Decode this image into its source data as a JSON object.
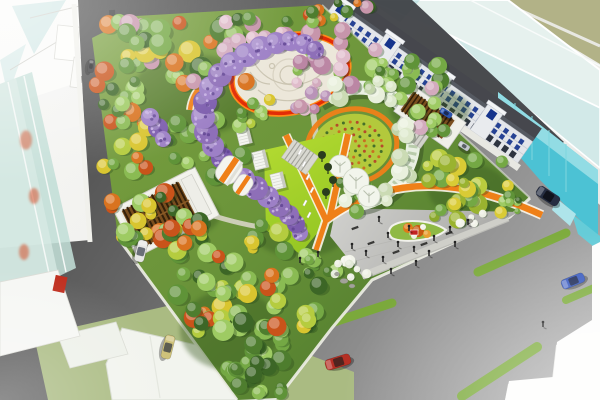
{
  "scene": {
    "description": "Aerial perspective rendering of an urban pocket-park masterplan: dense mixed tree canopy, purple wisteria tunnel, white circular plaza with red-orange ring path, spiral green trellis around a circular flower garden, chartreuse event lawn with orange V paths, timber pergola pavilions, grey entry plaza with pedestrians, surrounded by roads with cars, shophouse row and translucent glass towers",
    "canvas": {
      "width": 600,
      "height": 400
    }
  },
  "palette": {
    "asphalt_dark": "#3f3f3f",
    "asphalt_mid": "#656565",
    "asphalt_light": "#b5b5b5",
    "park_green": "#7aa040",
    "park_green_dark": "#4e7a2c",
    "lawn_bright": "#a8d32f",
    "path_orange": "#ef8018",
    "ring_red": "#e22c06",
    "plaza_white": "#ece7da",
    "concrete": "#c6c6c3",
    "curb_white": "#f0efe8",
    "glass_teal": "#c2ded6",
    "glass_cyan": "#4cc2d4",
    "building_white": "#f7f7f5",
    "shophouse_window": "#16348c",
    "pergola_brown": "#7a4e1e",
    "pergola_slat": "#33200a",
    "wisteria_purple": "#8e6fb8",
    "cherry_pink": "#c795ab",
    "lane_stripe_green": "#79af2e",
    "people_dark": "#2a2a2a"
  },
  "tree_palettes": {
    "greens": [
      "#3c6626",
      "#4e7d2e",
      "#5f9338",
      "#74a844",
      "#8abb53",
      "#9ecb63"
    ],
    "greensAccent": [
      "#3c6626",
      "#4e7d2e",
      "#5f9338",
      "#74a844",
      "#8abb53",
      "#9ecb63",
      "#d9731f",
      "#c9531a",
      "#d9c52f",
      "#b5cc3f"
    ],
    "mixNW": [
      "#3c6626",
      "#4e7d2e",
      "#5f9338",
      "#74a844",
      "#8abb53",
      "#d9731f",
      "#d9c52f",
      "#c795ab",
      "#c9531a",
      "#9ecb63"
    ],
    "pinks": [
      "#c795ab",
      "#d3abbe",
      "#bb86a4",
      "#e0bccb",
      "#b993b8"
    ],
    "pinkGreen": [
      "#c795ab",
      "#d3abbe",
      "#bb86a4",
      "#e0bccb",
      "#8abb53",
      "#9ecb63"
    ],
    "greenPink": [
      "#4e7d2e",
      "#5f9338",
      "#74a844",
      "#8abb53",
      "#9ecb63",
      "#c795ab",
      "#d3abbe"
    ],
    "yellowGreens": [
      "#b9cc3e",
      "#cbd84a",
      "#9ab32f",
      "#d9cb35",
      "#8aa82c",
      "#74a844"
    ],
    "sage": [
      "#dde8cc",
      "#cbdbb4",
      "#e9f0dd",
      "#c2d4aa"
    ],
    "whites": [
      "#edefe3",
      "#e2e8d6",
      "#f2f4ea"
    ]
  },
  "tree_clusters": [
    {
      "cx": 175,
      "cy": 55,
      "rx": 72,
      "ry": 34,
      "n": 40,
      "rmin": 6,
      "rmax": 12,
      "pal": "mixNW"
    },
    {
      "cx": 122,
      "cy": 128,
      "rx": 26,
      "ry": 52,
      "n": 22,
      "rmin": 5,
      "rmax": 10,
      "pal": "greensAccent"
    },
    {
      "cx": 158,
      "cy": 214,
      "rx": 52,
      "ry": 26,
      "n": 22,
      "rmin": 5,
      "rmax": 10,
      "pal": "greensAccent"
    },
    {
      "cx": 205,
      "cy": 150,
      "rx": 38,
      "ry": 32,
      "n": 16,
      "rmin": 5,
      "rmax": 10,
      "pal": "greens"
    },
    {
      "cx": 252,
      "cy": 34,
      "rx": 40,
      "ry": 17,
      "n": 12,
      "rmin": 5,
      "rmax": 9,
      "pal": "pinks"
    },
    {
      "cx": 342,
      "cy": 58,
      "rx": 46,
      "ry": 30,
      "n": 18,
      "rmin": 5,
      "rmax": 10,
      "pal": "pinkGreen"
    },
    {
      "cx": 305,
      "cy": 97,
      "rx": 26,
      "ry": 16,
      "n": 8,
      "rmin": 4,
      "rmax": 8,
      "pal": "pinks"
    },
    {
      "cx": 300,
      "cy": 14,
      "rx": 70,
      "ry": 11,
      "n": 14,
      "rmin": 4,
      "rmax": 8,
      "pal": "mixNW"
    },
    {
      "cx": 392,
      "cy": 80,
      "rx": 50,
      "ry": 26,
      "n": 18,
      "rmin": 5,
      "rmax": 9,
      "pal": "greenPink"
    },
    {
      "cx": 468,
      "cy": 188,
      "rx": 44,
      "ry": 32,
      "n": 24,
      "rmin": 5,
      "rmax": 10,
      "pal": "yellowGreens"
    },
    {
      "cx": 232,
      "cy": 238,
      "rx": 55,
      "ry": 18,
      "n": 18,
      "rmin": 5,
      "rmax": 10,
      "pal": "greensAccent"
    },
    {
      "cx": 210,
      "cy": 295,
      "rx": 40,
      "ry": 40,
      "n": 24,
      "rmin": 6,
      "rmax": 11,
      "pal": "greensAccent"
    },
    {
      "cx": 255,
      "cy": 345,
      "rx": 35,
      "ry": 35,
      "n": 20,
      "rmin": 6,
      "rmax": 11,
      "pal": "greens"
    },
    {
      "cx": 290,
      "cy": 300,
      "rx": 30,
      "ry": 28,
      "n": 14,
      "rmin": 5,
      "rmax": 10,
      "pal": "greensAccent"
    },
    {
      "cx": 320,
      "cy": 265,
      "rx": 20,
      "ry": 15,
      "n": 8,
      "rmin": 4,
      "rmax": 8,
      "pal": "greens"
    },
    {
      "cx": 258,
      "cy": 382,
      "rx": 26,
      "ry": 14,
      "n": 8,
      "rmin": 5,
      "rmax": 9,
      "pal": "greens"
    },
    {
      "cx": 360,
      "cy": 198,
      "rx": 26,
      "ry": 16,
      "n": 9,
      "rmin": 4,
      "rmax": 8,
      "pal": "greens"
    },
    {
      "cx": 255,
      "cy": 118,
      "rx": 26,
      "ry": 20,
      "n": 8,
      "rmin": 4,
      "rmax": 8,
      "pal": "greensAccent"
    },
    {
      "cx": 432,
      "cy": 122,
      "rx": 22,
      "ry": 14,
      "n": 7,
      "rmin": 4,
      "rmax": 8,
      "pal": "greenPink"
    },
    {
      "cx": 506,
      "cy": 206,
      "rx": 15,
      "ry": 11,
      "n": 6,
      "rmin": 3,
      "rmax": 6,
      "pal": "greens"
    },
    {
      "cx": 372,
      "cy": 92,
      "rx": 40,
      "ry": 13,
      "n": 10,
      "rmin": 5,
      "rmax": 9,
      "pal": "sage"
    },
    {
      "cx": 408,
      "cy": 148,
      "rx": 13,
      "ry": 28,
      "n": 8,
      "rmin": 5,
      "rmax": 9,
      "pal": "sage"
    },
    {
      "cx": 366,
      "cy": 196,
      "rx": 22,
      "ry": 9,
      "n": 6,
      "rmin": 4,
      "rmax": 8,
      "pal": "sage"
    },
    {
      "cx": 348,
      "cy": 268,
      "rx": 20,
      "ry": 10,
      "n": 8,
      "rmin": 3,
      "rmax": 6,
      "pal": "whites"
    },
    {
      "cx": 470,
      "cy": 218,
      "rx": 13,
      "ry": 6,
      "n": 5,
      "rmin": 3,
      "rmax": 5,
      "pal": "whites"
    }
  ],
  "wisteria_tunnel": {
    "colors": [
      "#8e6fb8",
      "#9d80c6",
      "#7c5cad"
    ],
    "dot_light": "#c9b4e4",
    "dot_dark": "#5e4290",
    "blobs": [
      [
        300,
        233,
        8
      ],
      [
        296,
        224,
        9
      ],
      [
        289,
        215,
        10
      ],
      [
        279,
        206,
        11
      ],
      [
        268,
        197,
        11
      ],
      [
        256,
        188,
        12
      ],
      [
        244,
        179,
        11
      ],
      [
        222,
        158,
        11
      ],
      [
        213,
        146,
        11
      ],
      [
        206,
        132,
        12
      ],
      [
        203,
        117,
        12
      ],
      [
        205,
        102,
        12
      ],
      [
        211,
        88,
        12
      ],
      [
        220,
        75,
        12
      ],
      [
        232,
        64,
        12
      ],
      [
        246,
        55,
        12
      ],
      [
        261,
        48,
        12
      ],
      [
        276,
        43,
        11
      ],
      [
        290,
        41,
        10
      ],
      [
        304,
        44,
        10
      ],
      [
        315,
        50,
        9
      ],
      [
        158,
        128,
        10
      ],
      [
        150,
        117,
        9
      ],
      [
        163,
        139,
        8
      ]
    ]
  },
  "flower_garden": {
    "cx": 352,
    "cy": 146,
    "rx": 40,
    "ry": 32,
    "rot": -10,
    "bed_color": "#b3c93c",
    "ring_color": "#ef8018",
    "row_radii": [
      30,
      22,
      14,
      7
    ],
    "dot_colors": [
      "#b5452a",
      "#3f6b28",
      "#c96a20"
    ]
  },
  "shophouse": {
    "length": 240,
    "height": 26,
    "floors_y": [
      4,
      11
    ],
    "ground_y": 18.5,
    "cols": 25,
    "spacing": 9.35,
    "win_w": 4.6,
    "win_h": 5,
    "window_color": "#16348c",
    "ground_color": "#2e3440",
    "towers_x": [
      -2,
      58,
      120,
      182
    ]
  },
  "cars": [
    {
      "name": "car-white-west-road",
      "x": 141,
      "y": 251,
      "rot": 104,
      "len": 22,
      "wid": 10,
      "body": "#e6e6e4",
      "glass": "#6a6f78"
    },
    {
      "name": "car-khaki-west-road",
      "x": 168,
      "y": 347,
      "rot": 104,
      "len": 24,
      "wid": 10,
      "body": "#cfc27a",
      "glass": "#5c5c50"
    },
    {
      "name": "car-dark-north-road",
      "x": 91,
      "y": 66,
      "rot": 96,
      "len": 13,
      "wid": 6,
      "body": "#3a3a3c",
      "glass": "#1e1e20"
    },
    {
      "name": "car-red-boulevard",
      "x": 338,
      "y": 362,
      "rot": -17,
      "len": 26,
      "wid": 11,
      "body": "#b52f24",
      "glass": "#50241f"
    },
    {
      "name": "car-blue-boulevard",
      "x": 573,
      "y": 281,
      "rot": -22,
      "len": 24,
      "wid": 10,
      "body": "#3b5cc0",
      "glass": "#23305c"
    },
    {
      "name": "van-dark-east-road",
      "x": 548,
      "y": 196,
      "rot": 33,
      "len": 25,
      "wid": 11,
      "body": "#262e42",
      "glass": "#10131c"
    },
    {
      "name": "car-blue-ne-road",
      "x": 446,
      "y": 113,
      "rot": 33,
      "len": 13,
      "wid": 6,
      "body": "#2b55b0",
      "glass": "#1a2a55"
    },
    {
      "name": "car-silver-ne-road",
      "x": 464,
      "y": 146,
      "rot": 33,
      "len": 12,
      "wid": 6,
      "body": "#c2c8cc",
      "glass": "#5a6066"
    }
  ],
  "lane_stripes": [
    {
      "x1": 103,
      "y1": 352,
      "x2": 196,
      "y2": 326,
      "w": 9
    },
    {
      "x1": 310,
      "y1": 330,
      "x2": 392,
      "y2": 303,
      "w": 9
    },
    {
      "x1": 478,
      "y1": 272,
      "x2": 566,
      "y2": 233,
      "w": 9
    },
    {
      "x1": 566,
      "y1": 300,
      "x2": 594,
      "y2": 288,
      "w": 8
    },
    {
      "x1": 462,
      "y1": 396,
      "x2": 537,
      "y2": 347,
      "w": 10
    }
  ],
  "people": [
    [
      352,
      249
    ],
    [
      366,
      256
    ],
    [
      383,
      262
    ],
    [
      398,
      247
    ],
    [
      414,
      252
    ],
    [
      434,
      241
    ],
    [
      450,
      232
    ],
    [
      468,
      225
    ],
    [
      409,
      231
    ],
    [
      388,
      238
    ],
    [
      300,
      263
    ],
    [
      318,
      257
    ],
    [
      429,
      256
    ],
    [
      455,
      247
    ],
    [
      391,
      274
    ],
    [
      416,
      266
    ],
    [
      379,
      222
    ],
    [
      543,
      327
    ]
  ],
  "plaza_benches": [
    [
      371,
      243
    ],
    [
      396,
      252
    ],
    [
      424,
      244
    ],
    [
      449,
      233
    ],
    [
      355,
      228
    ],
    [
      471,
      222
    ]
  ],
  "lawn_benches": [
    [
      300,
      152
    ],
    [
      304,
      164
    ],
    [
      308,
      177
    ],
    [
      312,
      190
    ],
    [
      305,
      203
    ],
    [
      309,
      215
    ]
  ],
  "lawn_sculptures": [
    [
      322,
      158
    ],
    [
      328,
      170
    ],
    [
      333,
      183
    ],
    [
      326,
      195
    ]
  ],
  "canopy_trees": [
    [
      340,
      166,
      11
    ],
    [
      356,
      181,
      13
    ],
    [
      369,
      196,
      11
    ]
  ],
  "kiosks": [
    {
      "x": 244,
      "y": 136,
      "w": 13,
      "h": 17,
      "rot": -14
    },
    {
      "x": 260,
      "y": 160,
      "w": 14,
      "h": 18,
      "rot": -14
    },
    {
      "x": 278,
      "y": 181,
      "w": 13,
      "h": 16,
      "rot": -14
    }
  ],
  "rocks": [
    [
      344,
      281,
      4,
      2.5
    ],
    [
      352,
      286,
      3,
      2
    ],
    [
      337,
      274,
      2.5,
      1.8
    ],
    [
      470,
      221,
      3,
      2
    ]
  ],
  "glass_red_accents": [
    [
      26,
      140,
      6
    ],
    [
      34,
      196,
      5
    ],
    [
      24,
      252,
      5
    ],
    [
      40,
      300,
      6
    ],
    [
      30,
      326,
      4
    ]
  ],
  "island_trees": [
    [
      408,
      228,
      5,
      "#e07818"
    ],
    [
      418,
      231,
      6,
      "#c85a10"
    ],
    [
      427,
      234,
      4,
      "#e8a030"
    ],
    [
      414,
      236,
      3,
      "#eef0e4"
    ],
    [
      423,
      227,
      3,
      "#f2f4ea"
    ]
  ]
}
